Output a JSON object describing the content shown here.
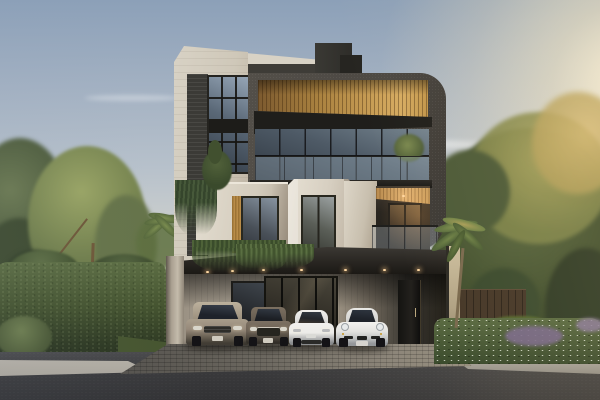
{
  "scene": {
    "type": "architectural-rendering",
    "description": "Photorealistic exterior rendering of a modern three-storey luxury townhouse at sunset, with a carport sheltering four cars, lush landscaping on both sides and an asphalt street in the foreground",
    "time_of_day": "sunset / golden hour",
    "camera": "street-level frontal view"
  },
  "colors": {
    "sky_top": "#8ca0b8",
    "sky_mid": "#b7c1cb",
    "sky_horizon": "#ddd8cc",
    "sun_glow": "#fbf0d6",
    "cloud_white": "#ffffff",
    "charcoal_facade": "#4c4843",
    "stone_travertine": "#d8d2c5",
    "stone_shadow": "#b4a897",
    "wood_soffit_light": "#d6ac62",
    "wood_soffit_dark": "#7c5a2f",
    "glass_reflection": "#75848f",
    "glass_deep": "#2e363f",
    "fascia": "#1f1e1b",
    "canopy": "#26231f",
    "downlight_warm": "#ffd9a4",
    "ground_stone": "#b6ad9e",
    "entry_black": "#141311",
    "pillar": "#c4bbab",
    "paver_sunlit": "#8c8579",
    "paver_shade": "#53504b",
    "asphalt": "#3a3a3c",
    "curb": "#aba69c",
    "hedge_green": "#44532f",
    "foliage_olive": "#7f8c58",
    "foliage_dark": "#3f4c31",
    "foliage_gold": "#d6ba74",
    "palm_green": "#6f8247",
    "lawn": "#55682f",
    "pool": "#2e6e62",
    "fence": "#453728",
    "flowers_purple": "#7a6a8a",
    "car_champagne": "#96897a",
    "car_bronze": "#6b6054",
    "car_white": "#ecebe8",
    "tire": "#141316",
    "windshield": "#1e222a"
  },
  "building": {
    "storeys": 3,
    "materials": [
      "travertine stone cladding",
      "charcoal textured render with rounded corner",
      "golden wood-slat soffits",
      "dark metal window frames",
      "glass balustrades"
    ],
    "features": [
      "stone tower volume with gridded window",
      "rooftop stair core",
      "full-width glass living level",
      "chamfered stone window surrounds",
      "recessed sunset-lit balcony",
      "carport canopy with recessed downlights",
      "hanging vine planters",
      "dark entry door",
      "stone pier columns"
    ]
  },
  "vehicles": [
    {
      "name": "champagne-suv",
      "type": "large luxury SUV",
      "color": "champagne gray"
    },
    {
      "name": "bronze-suv",
      "type": "mid-size SUV",
      "color": "dark bronze"
    },
    {
      "name": "white-sedan",
      "type": "electric sedan",
      "color": "white"
    },
    {
      "name": "white-sports-car",
      "type": "sports coupe",
      "color": "white"
    }
  ],
  "landscape": {
    "left": [
      "tall background trees",
      "feathery olive-green tree with slim trunk",
      "small palm",
      "dense clipped hedge",
      "grass verge"
    ],
    "right": [
      "sunlit golden trees",
      "palm tree",
      "timber boundary fence",
      "small lap pool with deck",
      "lawn",
      "flowering shrub bed with white and purple blooms"
    ],
    "foreground": [
      "cobblestone paver driveway apron",
      "light concrete curb",
      "asphalt road"
    ]
  },
  "lighting": {
    "sun_position": "upper right",
    "description": "warm low sun glow from the right, cool blue sky upper left, wispy clouds mid-sky"
  }
}
